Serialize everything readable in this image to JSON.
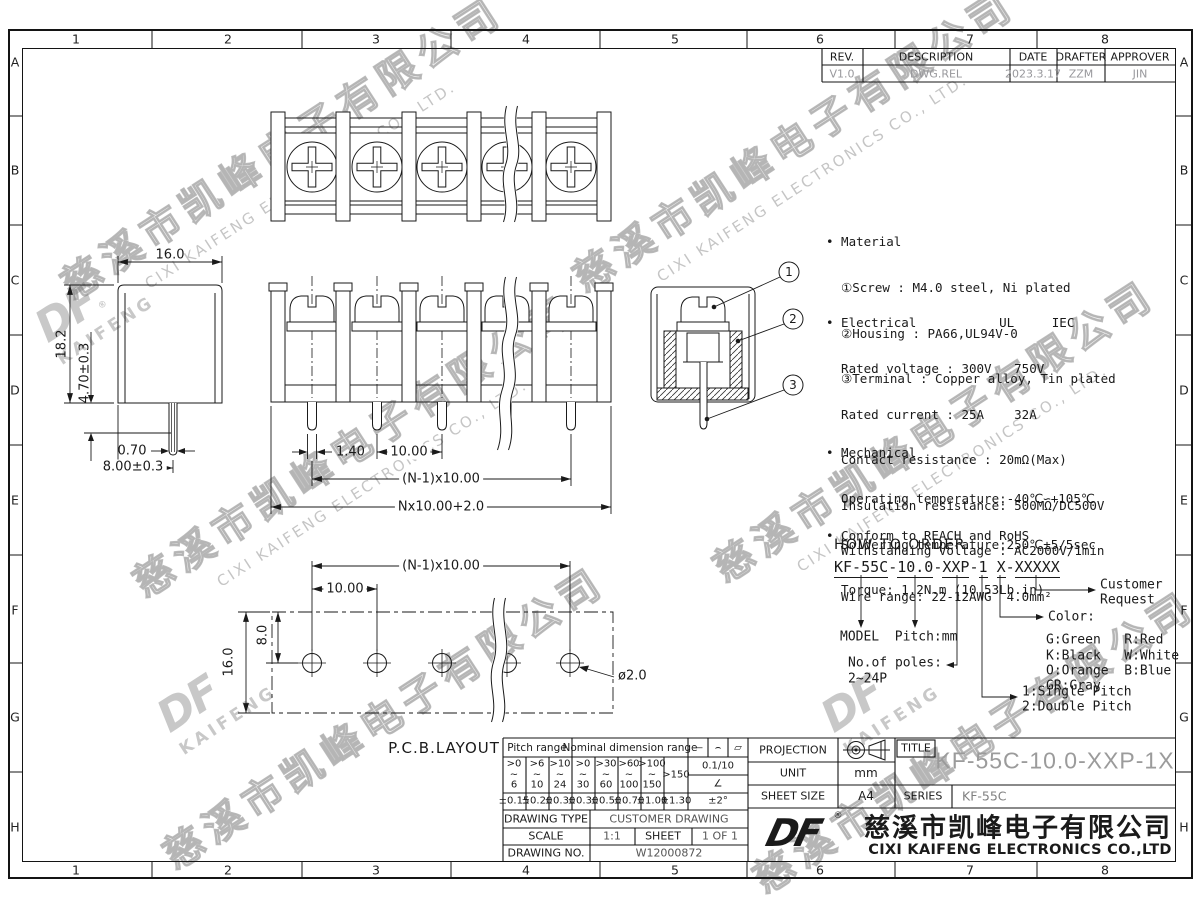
{
  "zones": {
    "cols": [
      "1",
      "2",
      "3",
      "4",
      "5",
      "6",
      "7",
      "8"
    ],
    "rows": [
      "A",
      "B",
      "C",
      "D",
      "E",
      "F",
      "G",
      "H"
    ]
  },
  "revision": {
    "headers": [
      "REV.",
      "DESCRIPTION",
      "DATE",
      "DRAFTER",
      "APPROVER"
    ],
    "values": [
      "V1.0",
      "DWG.REL",
      "2023.3.17",
      "ZZM",
      "JIN"
    ]
  },
  "specs": {
    "lines": [
      "• Material",
      "  ①Screw : M4.0 steel, Ni plated",
      "  ②Housing : PA66,UL94V-0",
      "  ③Terminal : Copper alloy, Tin plated",
      "• Electrical           UL     IEC",
      "  Rated voltage : 300V   750V",
      "  Rated current : 25A    32A",
      "  Contact resistance : 20mΩ(Max)",
      "  Insulation resistance: 500MΩ/DC500V",
      "  Withstanding Voltage : AC2000V/1min",
      "  Wire range: 22-12AWG  4.0mm²",
      "• Mechanical",
      "  Operating temperature:-40℃∽+105℃",
      "  Soldering temperature:250℃±5/5sec",
      "  Torque: 1.2N.m (10.53Lb.in)",
      "• Conform to REACH and RoHS"
    ]
  },
  "order": {
    "title": "HOW TO ORDER",
    "segments": [
      "KF-55C",
      "10.0",
      "XXP",
      "1",
      "X",
      "XXXXX"
    ],
    "seps": [
      "-",
      "-",
      "-",
      " ",
      "-"
    ],
    "labels": {
      "model_pitch": "MODEL  Pitch:mm",
      "poles1": "No.of poles:",
      "poles2": "2~24P",
      "color": "Color:",
      "c1": "G:Green   R:Red",
      "c2": "K:Black   W:White",
      "c3": "O:Orange  B:Blue",
      "c4": "GR:Gray",
      "p1": "1:Single Pitch",
      "p2": "2:Double Pitch",
      "cust1": "Customer",
      "cust2": "Request"
    }
  },
  "dims": {
    "side": [
      "16.0",
      "18.2",
      "4.70±0.3",
      "0.70",
      "8.00±0.3"
    ],
    "front": [
      "1.40",
      "10.00",
      "(N-1)x10.00",
      "Nx10.00+2.0"
    ],
    "pcb": [
      "(N-1)x10.00",
      "10.00",
      "8.0",
      "16.0",
      "ø2.0"
    ],
    "pcb_label": "P.C.B.LAYOUT",
    "callouts": [
      "1",
      "2",
      "3"
    ]
  },
  "tol_table": {
    "h1": "Pitch range",
    "h2": "Nominal dimension range",
    "symbols": [
      "—",
      "⌢",
      "▱"
    ],
    "ranges": [
      ">0\n~\n6",
      ">6\n~\n10",
      ">10\n~\n24",
      ">0\n~\n30",
      ">30\n~\n60",
      ">60\n~\n100",
      ">100\n~\n150",
      ">150"
    ],
    "flat": "0.1/10",
    "angle_sym": "∠",
    "tols": [
      "±0.15",
      "±0.20",
      "±0.30",
      "±0.30",
      "±0.50",
      "±0.70",
      "±1.00",
      "±1.30",
      "±2°"
    ]
  },
  "info": {
    "drawing_type_label": "DRAWING TYPE",
    "drawing_type": "CUSTOMER DRAWING",
    "scale_label": "SCALE",
    "scale": "1:1",
    "sheet_label": "SHEET",
    "sheet": "1 OF 1",
    "drawing_no_label": "DRAWING NO.",
    "drawing_no": "W12000872",
    "projection_label": "PROJECTION",
    "unit_label": "UNIT",
    "unit": "mm",
    "sheet_size_label": "SHEET SIZE",
    "sheet_size": "A4",
    "title_label": "TITLE",
    "title": "KF-55C-10.0-XXP-1X",
    "series_label": "SERIES",
    "series": "KF-55C"
  },
  "company": {
    "logo": "DF",
    "reg": "®",
    "cn": "慈溪市凯峰电子有限公司",
    "en": "CIXI KAIFENG ELECTRONICS CO.,LTD"
  },
  "watermark": {
    "cn": "慈溪市凯峰电子有限公司",
    "en": "CIXI KAIFENG ELECTRONICS CO., LTD.",
    "logo": "DF",
    "logo_sub": "KAIFENG",
    "reg": "®"
  }
}
